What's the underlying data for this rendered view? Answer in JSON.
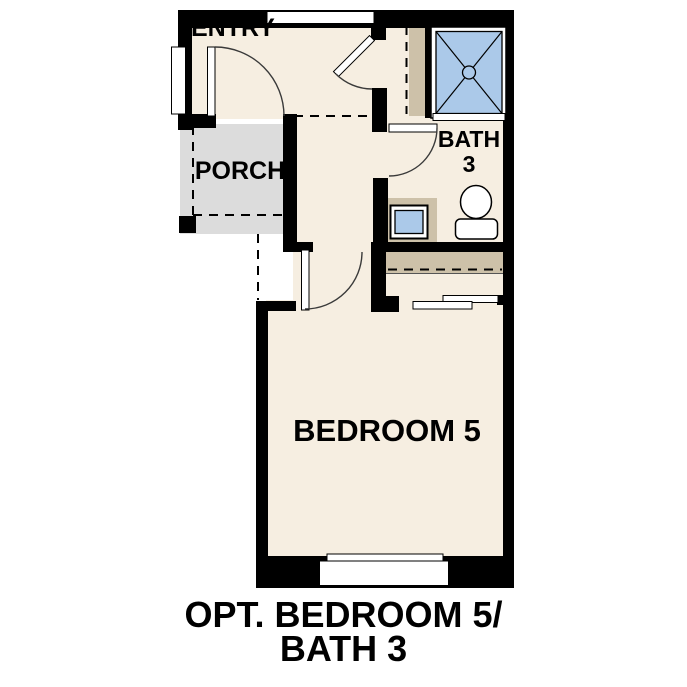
{
  "caption": {
    "line1": "OPT. BEDROOM 5/",
    "line2": "BATH 3"
  },
  "rooms": {
    "entry": {
      "label": "ENTRY"
    },
    "porch": {
      "label": "PORCH"
    },
    "bath": {
      "label_line1": "BATH",
      "label_line2": "3"
    },
    "bedroom": {
      "label": "BEDROOM 5"
    }
  },
  "colors": {
    "wall": "#000000",
    "floor": "#f6eee1",
    "porch": "#dcdcdc",
    "shelf": "#cdc1a9",
    "fixture_blue": "#abc9e9",
    "outline": "#3a3a3a",
    "text": "#000000",
    "background": "#ffffff"
  }
}
